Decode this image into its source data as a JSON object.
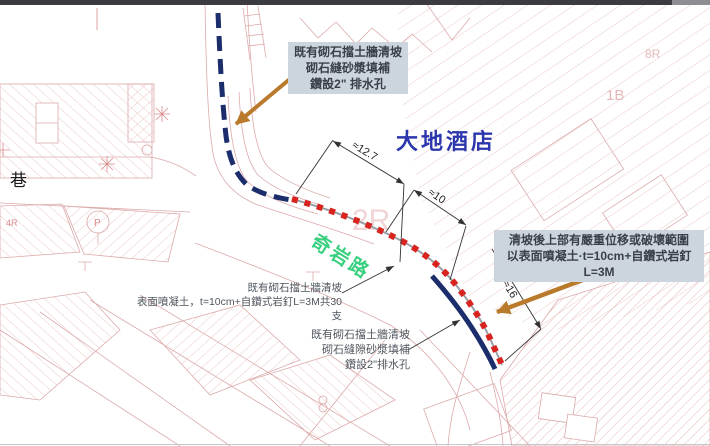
{
  "frame": {
    "topbar_color": "#3b3b40"
  },
  "labels": {
    "hotel": "大地酒店",
    "road": "奇岩路",
    "lane": "巷"
  },
  "dims": {
    "d1": "≈12.7",
    "d2": "≈10",
    "d3": "≈16"
  },
  "notes": {
    "top_box": [
      "既有砌石擋土牆清坡",
      "砌石縫砂漿填補",
      "鑽設2\" 排水孔"
    ],
    "right_box": [
      "清坡後上部有嚴重位移或破壞範圍",
      "以表面噴凝土·t=10cm+自鑽式岩釘L=3M"
    ],
    "left_note": [
      "既有砌石擋土牆清坡",
      "表面噴凝土，t=10cm+自鑽式岩釘L=3M共30支"
    ],
    "bottom_note": [
      "既有砌石擋土牆清坡",
      "砌石縫隙砂漿填補",
      "鑽設2\"排水孔"
    ]
  },
  "basemap_texts": {
    "t2r": "2R",
    "t1b": "1B",
    "t8r": "8R",
    "t4r": "4R",
    "tp": "P"
  },
  "colors": {
    "route_blue": "#1b2d6b",
    "marker_red": "#d9231f",
    "arrow_orange": "#b97a2c",
    "hotel_blue": "#2b35ac",
    "road_green": "#38cf7e",
    "cad_pink": "#dcaaaa",
    "note_gray": "#4f565e",
    "box_bg": "#ccd4de"
  }
}
